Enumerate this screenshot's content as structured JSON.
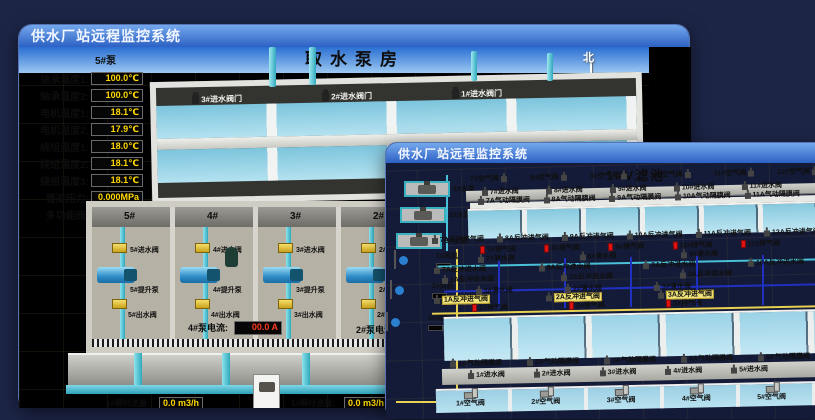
{
  "back_window": {
    "title": "供水厂站远程监控系统",
    "scene_title": "取水泵房",
    "compass": {
      "north": "北",
      "south": "南",
      "west": "西",
      "east": "东"
    },
    "pump_panel": {
      "title": "5#泵",
      "rows": [
        {
          "label": "轴承温度1:",
          "value": "100.0℃"
        },
        {
          "label": "轴承温度2:",
          "value": "100.0℃"
        },
        {
          "label": "电机温度1:",
          "value": "18.1℃"
        },
        {
          "label": "电机温度2:",
          "value": "17.9℃"
        },
        {
          "label": "绕组温度1:",
          "value": "18.0℃"
        },
        {
          "label": "绕组温度2:",
          "value": "18.1℃"
        },
        {
          "label": "绕组温度3:",
          "value": "18.1℃"
        },
        {
          "label": "管道压力:",
          "value": "0.000MPa"
        },
        {
          "label": "多功能阀:",
          "value": "0%"
        }
      ]
    },
    "right_panel": {
      "title": "1#泵",
      "labels": [
        "轴承温度1",
        "轴承温度2"
      ]
    },
    "intake_valves": [
      "3#进水阀门",
      "2#进水阀门",
      "1#进水阀门"
    ],
    "bays": [
      {
        "no": "5#",
        "inlet": "5#进水阀",
        "pump": "5#提升泵",
        "outlet": "5#出水阀"
      },
      {
        "no": "4#",
        "inlet": "4#进水阀",
        "pump": "4#提升泵",
        "outlet": "4#出水阀"
      },
      {
        "no": "3#",
        "inlet": "3#进水阀",
        "pump": "3#提升泵",
        "outlet": "3#出水阀"
      },
      {
        "no": "2#",
        "inlet": "2#进水阀",
        "pump": "2#提升泵",
        "outlet": "2#出水阀"
      }
    ],
    "current_readouts": [
      {
        "label": "4#泵电流:",
        "value": "00.0 A"
      },
      {
        "label": "2#泵电流:",
        "value": ""
      }
    ],
    "flow_readouts": [
      {
        "label": "1#瞬时流量:",
        "value": "0.0 m3/h"
      },
      {
        "label": "1#瞬时流量:",
        "value": "0.0 m3/h"
      }
    ]
  },
  "front_window": {
    "title": "供水厂站远程监控系统",
    "scene_title": "1#V滤池",
    "left_pumps": [
      "1#水泵",
      "2#水泵",
      "3#水泵"
    ],
    "left_blowers": [
      "1#风机",
      "2#风机",
      "3#风机"
    ],
    "top_air_valves": [
      "7#空气阀",
      "8#空气阀",
      "9#空气阀",
      "10#空气阀",
      "11#空气阀",
      "12#空气阀"
    ],
    "top_inlet_valves": [
      "7#进水阀",
      "8#进水阀",
      "9#进水阀",
      "10#进水阀",
      "11#进水阀"
    ],
    "top_diaphragm_valves": [
      "7A气动隔膜阀",
      "8A气动隔膜阀",
      "9A气动隔膜阀",
      "10A气动隔膜阀",
      "11A气动隔膜阀"
    ],
    "top_backwash_air_valves": [
      "7A反冲进气阀",
      "8A反冲进气阀",
      "9A反冲进气阀",
      "10A反冲进气阀",
      "11A反冲进气阀",
      "12A反冲进气阀"
    ],
    "top_exhaust_valves": [
      "7#排气阀",
      "8#排气阀",
      "9#排气阀",
      "10#排气阀",
      "11#排气阀"
    ],
    "top_clean_valves": [
      "7#清水阀",
      "8#清水阀",
      "9#清水阀"
    ],
    "top_backwash_water_valves": [
      "7A反冲进水阀",
      "8A反冲进水阀",
      "9A反冲进水阀",
      "10A反冲进水阀"
    ],
    "bottom_backwash_water_valves": [
      "1A反冲进水阀",
      "2A反冲进水阀",
      "3A反冲进水阀"
    ],
    "bottom_clean_valves": [
      "1#清水阀",
      "2#清水阀",
      "3#清水阀"
    ],
    "bottom_backwash_air_valves": [
      "1A反冲进气阀",
      "2A反冲进气阀",
      "3A反冲进气阀"
    ],
    "bottom_exhaust_valves": [
      "1#排气阀",
      "2#排气阀",
      "3#排气阀"
    ],
    "bottom_diaphragm_valves": [
      "1A气动隔膜阀",
      "2A气动隔膜阀",
      "3A气动隔膜阀",
      "4A气动隔膜阀",
      "5A气动隔膜阀"
    ],
    "bottom_inlet_valves": [
      "1#进水阀",
      "2#进水阀",
      "3#进水阀",
      "4#进水阀",
      "5#进水阀"
    ],
    "bottom_air_valves": [
      "1#空气阀",
      "2#空气阀",
      "3#空气阀",
      "4#空气阀",
      "5#空气阀"
    ]
  }
}
